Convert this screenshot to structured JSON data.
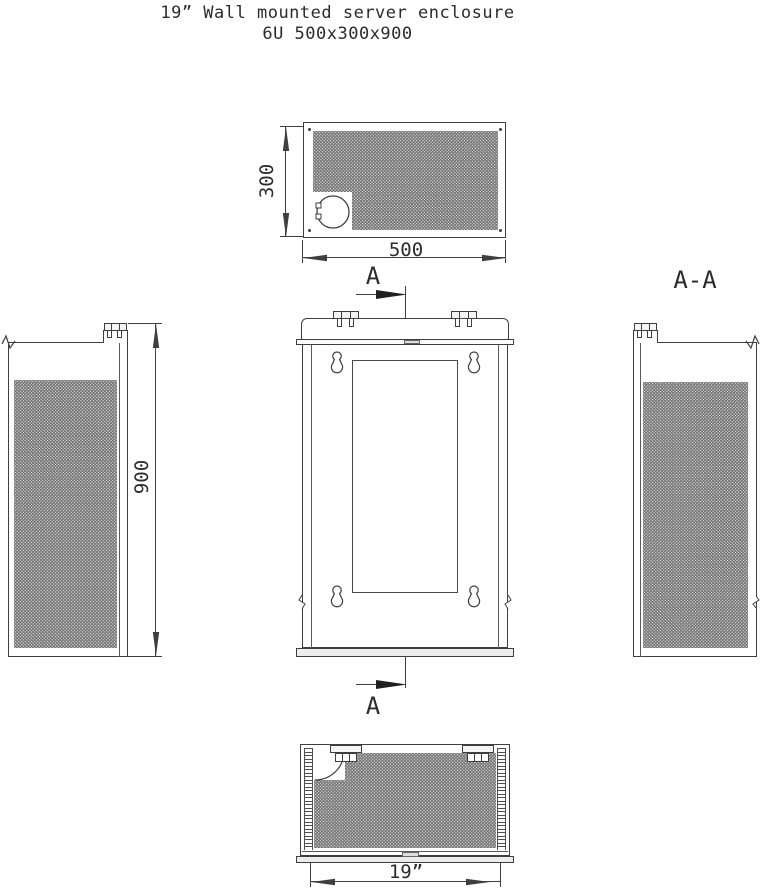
{
  "title": {
    "line1": "19” Wall mounted server enclosure",
    "line2": "6U 500x300x900"
  },
  "top_view": {
    "dim_depth": "300",
    "dim_width": "500"
  },
  "section_cut": {
    "label_top": "A",
    "label_bottom": "A"
  },
  "side_view": {
    "dim_height": "900"
  },
  "section_view": {
    "label": "A-A"
  },
  "bottom_view": {
    "dim_width": "19”"
  },
  "colors": {
    "line": "#3f3f3f",
    "perforation_dot": "#757575",
    "panel_fill": "#ececec",
    "background": "#ffffff"
  }
}
